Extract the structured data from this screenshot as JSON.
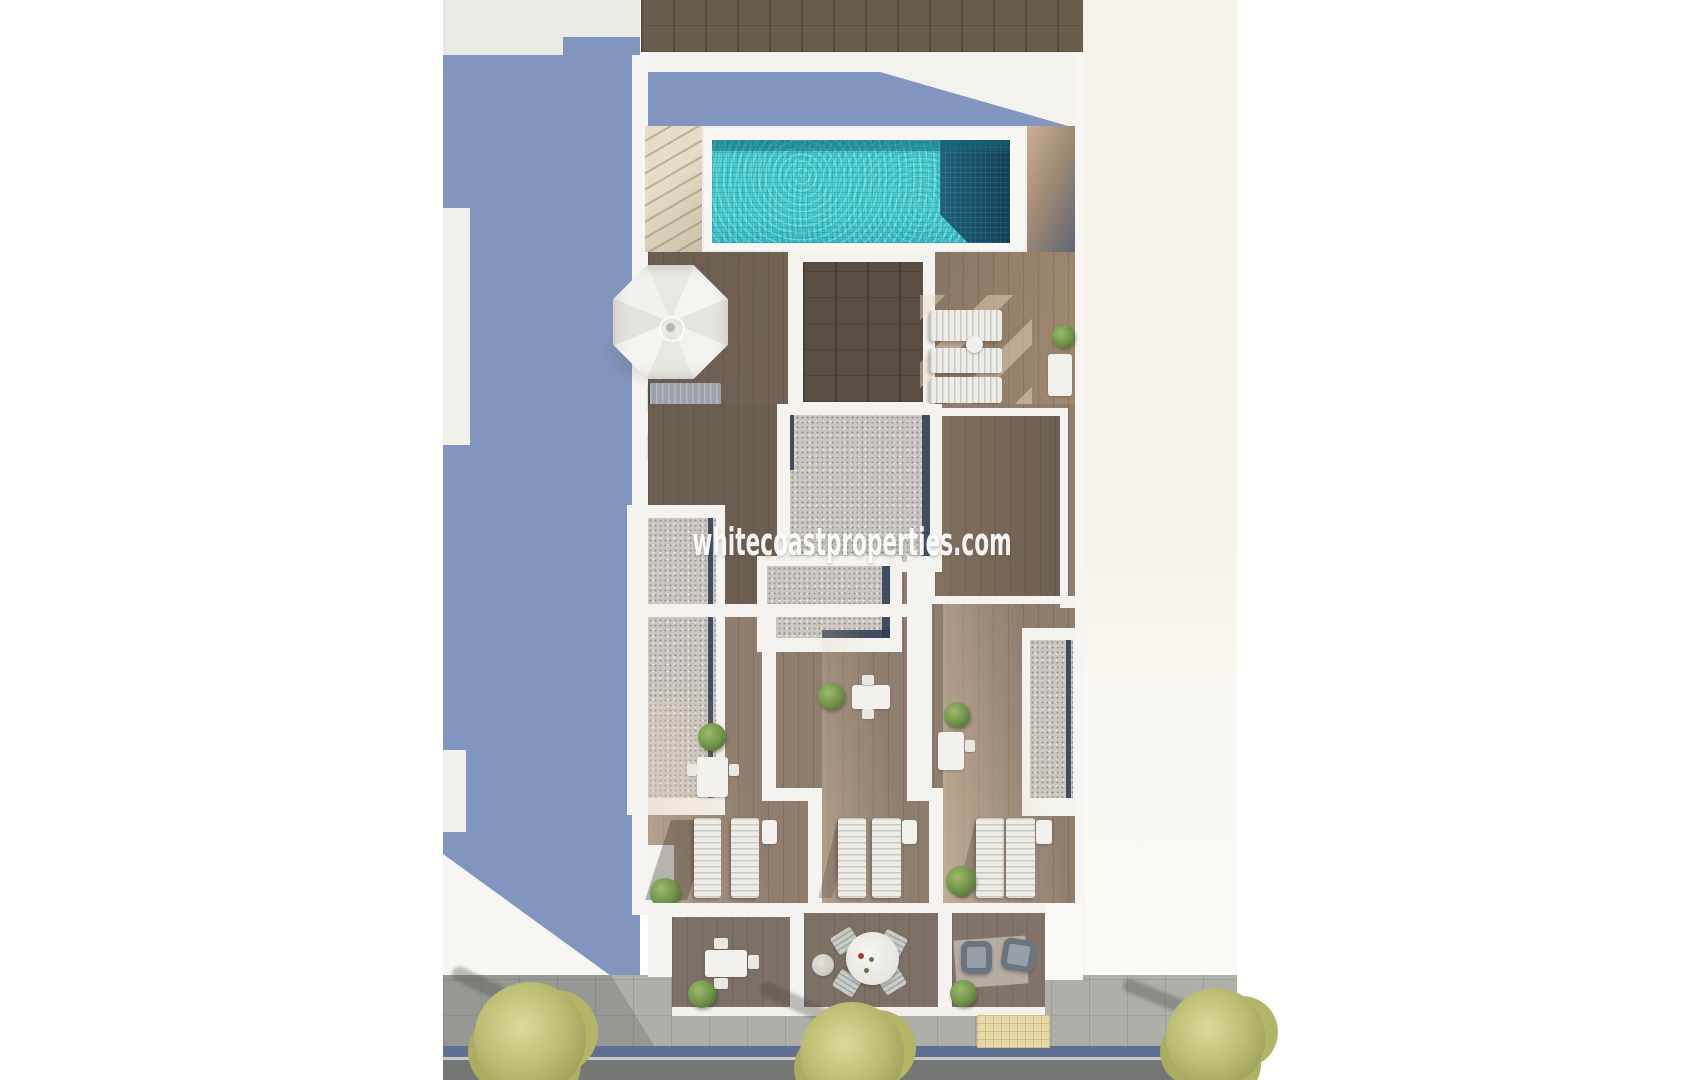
{
  "watermark": {
    "text": "whitecoastproperties.com"
  },
  "scene": {
    "kind": "aerial-3d-architectural-render",
    "subject": "rooftop-terraces-with-pool-over-street"
  },
  "colors": {
    "page_bg": "#FFFFFF",
    "shadow_blue": "#8295BE",
    "roof_gray": "#EAE9E5",
    "wall_white": "#F4F3EF",
    "wall_bright": "#FAF9F5",
    "cream_side": "#F6F2E9",
    "wood_dark_strip": "#6B5D4D",
    "deck_wood": "#8A7765",
    "deck_wood_shadow": "#6B5D51",
    "terrace_wood": "#8F7D6E",
    "balcony_wood": "#7D7066",
    "pergola_wood": "#5A4D41",
    "room_wood": "#75655A",
    "pool_water": "#3AC6CB",
    "pool_deep": "#16506B",
    "stairs_beige": "#E7DCC8",
    "gravel": "#CAC7C1",
    "navy_trim": "#2E3D52",
    "parasol_white": "#F2F1ED",
    "lounger_white": "#EDECE7",
    "lounger_gray": "#9CA2A7",
    "plant_green": "#6E9148",
    "tree_olive": "#BCBE74",
    "sidewalk": "#AEAFA9",
    "curb_blue": "#5F7090",
    "asphalt": "#747776",
    "mat_cream": "#E3D8A9"
  }
}
